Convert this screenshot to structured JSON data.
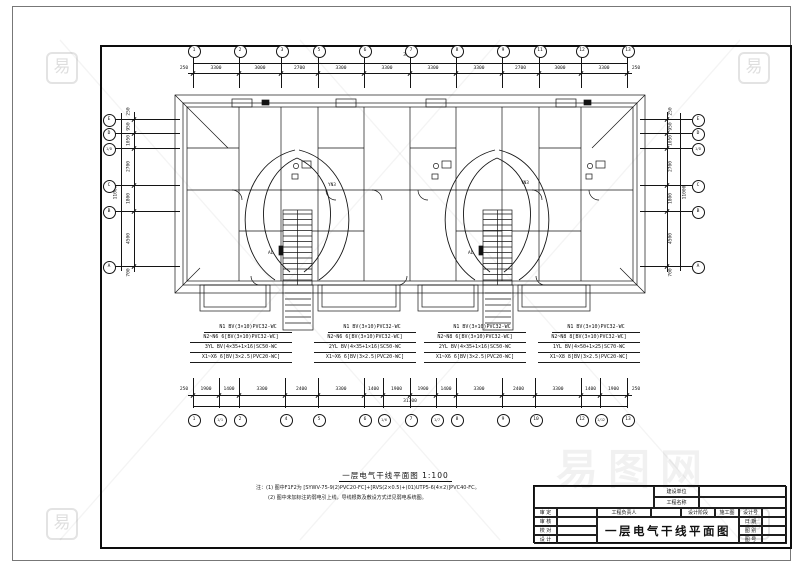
{
  "sheet": {
    "caption": {
      "title": "一层电气干线平面图",
      "scale": "1:100"
    },
    "notes": [
      "注：(1) 图中F1F2为 [SYWV-75-9(2)PVC20-FC]+[RVS(2×0.5)+(01)UTP5-6(4×2)]PVC40-FC。",
      "(2) 图中未加标注的弱电引上线，导线根数及敷设方式详见弱电系统图。"
    ]
  },
  "axes": {
    "top": {
      "overall": "31700",
      "edge_start": "250",
      "edge_end": "250",
      "bubbles": [
        "1",
        "2",
        "3",
        "5",
        "6",
        "7",
        "8",
        "9",
        "11",
        "12",
        "13"
      ],
      "spans": [
        "3300",
        "3000",
        "2700",
        "3300",
        "3300",
        "3300",
        "3300",
        "2700",
        "3000",
        "3300"
      ]
    },
    "bottom": {
      "overall": "31700",
      "edge_start": "250",
      "edge_end": "250",
      "bubbles": [
        "1",
        "1/1",
        "2",
        "4",
        "5",
        "6",
        "1/6",
        "7",
        "1/7",
        "8",
        "9",
        "10",
        "12",
        "1/12",
        "13"
      ],
      "spans": [
        "1900",
        "1400",
        "3300",
        "2400",
        "3300",
        "1400",
        "1900",
        "1900",
        "1400",
        "3300",
        "2400",
        "3300",
        "1400",
        "1900"
      ]
    },
    "left": {
      "overall": "11000",
      "edge_start": "250",
      "edge_end": "700",
      "bubbles": [
        "E",
        "D",
        "1/D",
        "C",
        "B",
        "A"
      ],
      "spans": [
        "950",
        "1050",
        "2700",
        "1800",
        "4500"
      ]
    },
    "right": {
      "overall": "11000",
      "edge_start": "250",
      "edge_end": "700",
      "bubbles": [
        "E",
        "D",
        "1/D",
        "C",
        "B",
        "A"
      ],
      "spans": [
        "950",
        "1050",
        "2700",
        "1800",
        "4500"
      ]
    }
  },
  "feeders": {
    "blocks": [
      {
        "lines": [
          "N1 BV(3×10)PVC32-WC",
          "N2~N6 6[BV(3×10)PVC32-WC]",
          "3YL BV(4×35+1×16)SC50-WC",
          "X1~X6 6[BV(3×2.5)PVC20-WC]"
        ]
      },
      {
        "lines": [
          "N1 BV(3×10)PVC32-WC",
          "N2~N6 6[BV(3×10)PVC32-WC]",
          "2YL BV(4×35+1×16)SC50-WC",
          "X1~X6 6[BV(3×2.5)PVC20-WC]"
        ]
      },
      {
        "lines": [
          "N1 BV(3×10)PVC32-WC",
          "N2~N8 6[BV(3×10)PVC32-WC]",
          "2YL BV(4×35+1×16)SC50-WC",
          "X1~X6 6[BV(3×2.5)PVC20-WC]"
        ]
      },
      {
        "lines": [
          "N1 BV(3×10)PVC32-WC",
          "N2~N8 8[BV(3×10)PVC32-WC]",
          "1YL BV(4×50+1×25)SC70-WC",
          "X1~X8 8[BV(3×2.5)PVC20-WC]"
        ]
      }
    ]
  },
  "plan_labels": {
    "run_left": "YN3",
    "run_right": "YN3",
    "panel_left": "AL",
    "panel_right": "AL"
  },
  "titleblock": {
    "client_label": "建设单位",
    "project_label": "工程名称",
    "approver_label": "审 定",
    "checker_label": "审 核",
    "proof_label": "校 对",
    "designer_label": "设 计",
    "lead_label": "工程负责人",
    "stage_label": "设计阶段",
    "stage_value": "施工图",
    "title": "一层电气干线平面图",
    "design_no_label": "设计号",
    "date_label": "日 期",
    "category_label": "图 别",
    "sheet_no_label": "图 号"
  },
  "watermark": {
    "logo": "易",
    "brand": "易图网"
  }
}
